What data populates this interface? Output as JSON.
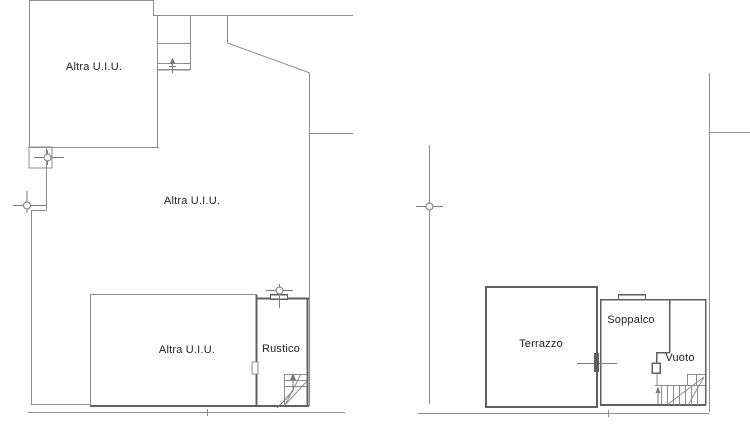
{
  "document_type": "cadastral floor plan drawing",
  "colors": {
    "background": "#ffffff",
    "line": "#8c8c8c",
    "wall": "#5f5f5f",
    "marker": "#7a7a7a",
    "text": "#222222",
    "white": "#ffffff"
  },
  "labels": {
    "room_upper_left": "Altra U.I.U.",
    "room_middle": "Altra U.I.U.",
    "room_lower": "Altra U.I.U.",
    "rustico": "Rustico",
    "terrazzo": "Terrazzo",
    "soppalco": "Soppalco",
    "vuoto": "Vuoto"
  },
  "floorplan": {
    "lines": [
      {
        "x1": 29,
        "y1": 0.5,
        "x2": 153,
        "y2": 0.5,
        "w": 1,
        "c": "line",
        "n": "top-wall"
      },
      {
        "x1": 29.5,
        "y1": 0,
        "x2": 29.5,
        "y2": 147,
        "w": 1,
        "c": "line",
        "n": "left-wall"
      },
      {
        "x1": 153.5,
        "y1": 0,
        "x2": 153.5,
        "y2": 15,
        "w": 1,
        "c": "line",
        "n": "wall-step"
      },
      {
        "x1": 153,
        "y1": 15.5,
        "x2": 353,
        "y2": 15.5,
        "w": 1,
        "c": "line",
        "n": "top-wall-right"
      },
      {
        "x1": 157.5,
        "y1": 15,
        "x2": 157.5,
        "y2": 147,
        "w": 1,
        "c": "line",
        "n": "shaft-left-wall"
      },
      {
        "x1": 190.5,
        "y1": 15,
        "x2": 190.5,
        "y2": 70,
        "w": 1,
        "c": "line",
        "n": "shaft-right-wall"
      },
      {
        "x1": 157,
        "y1": 43.5,
        "x2": 190,
        "y2": 43.5,
        "w": 1,
        "c": "line",
        "n": "shaft-landing-line"
      },
      {
        "x1": 157,
        "y1": 63.5,
        "x2": 190,
        "y2": 63.5,
        "w": 1,
        "c": "line",
        "n": "shaft-sill-outer"
      },
      {
        "x1": 157,
        "y1": 69.5,
        "x2": 190,
        "y2": 69.5,
        "w": 1.5,
        "c": "line",
        "n": "shaft-sill-inner"
      },
      {
        "x1": 172.5,
        "y1": 59,
        "x2": 172.5,
        "y2": 73,
        "w": 1,
        "c": "marker",
        "n": "shaft-arrow-shaft"
      },
      {
        "x1": 169,
        "y1": 66.5,
        "x2": 176,
        "y2": 66.5,
        "w": 1,
        "c": "marker",
        "n": "shaft-arrow-crossbar"
      },
      {
        "x1": 227.5,
        "y1": 15,
        "x2": 227.5,
        "y2": 43,
        "w": 1,
        "c": "line",
        "n": "upper-right-wall"
      },
      {
        "x1": 227.5,
        "y1": 43,
        "x2": 310,
        "y2": 73,
        "w": 1,
        "c": "line",
        "n": "diagonal-wall"
      },
      {
        "x1": 309.5,
        "y1": 73,
        "x2": 309.5,
        "y2": 406,
        "w": 1,
        "c": "line",
        "n": "right-wall"
      },
      {
        "x1": 310,
        "y1": 133.5,
        "x2": 353,
        "y2": 133.5,
        "w": 1,
        "c": "line",
        "n": "party-wall-line"
      },
      {
        "x1": 29,
        "y1": 147.5,
        "x2": 159,
        "y2": 147.5,
        "w": 1,
        "c": "line",
        "n": "room-divider-wall"
      },
      {
        "x1": 34,
        "y1": 157.5,
        "x2": 64,
        "y2": 157.5,
        "w": 1,
        "c": "marker",
        "n": "axis-marker-line"
      },
      {
        "x1": 47.5,
        "y1": 150,
        "x2": 47.5,
        "y2": 165,
        "w": 1,
        "c": "marker",
        "n": "axis-marker-line"
      },
      {
        "x1": 46.5,
        "y1": 147,
        "x2": 46.5,
        "y2": 210.5,
        "w": 1,
        "c": "line",
        "n": "mid-left-wall-upper"
      },
      {
        "x1": 31,
        "y1": 210.5,
        "x2": 46.5,
        "y2": 210.5,
        "w": 1,
        "c": "line",
        "n": "wall-jog"
      },
      {
        "x1": 31.5,
        "y1": 210.5,
        "x2": 31.5,
        "y2": 404,
        "w": 1,
        "c": "line",
        "n": "mid-left-wall-lower"
      },
      {
        "x1": 13,
        "y1": 205.5,
        "x2": 46,
        "y2": 205.5,
        "w": 1,
        "c": "marker",
        "n": "axis-marker-line"
      },
      {
        "x1": 27,
        "y1": 191,
        "x2": 27,
        "y2": 213,
        "w": 1,
        "c": "marker",
        "n": "axis-marker-line"
      },
      {
        "x1": 31,
        "y1": 404.5,
        "x2": 90,
        "y2": 404.5,
        "w": 1,
        "c": "line",
        "n": "annex-bottom-wall"
      },
      {
        "x1": 90.5,
        "y1": 294,
        "x2": 90.5,
        "y2": 407,
        "w": 1,
        "c": "line",
        "n": "lower-room-left-wall"
      },
      {
        "x1": 90,
        "y1": 294.5,
        "x2": 257,
        "y2": 294.5,
        "w": 1,
        "c": "line",
        "n": "lower-room-top-wall"
      },
      {
        "x1": 90,
        "y1": 406,
        "x2": 309,
        "y2": 406,
        "w": 2,
        "c": "wall",
        "n": "lower-room-bottom-wall"
      },
      {
        "x1": 256.5,
        "y1": 295,
        "x2": 256.5,
        "y2": 406,
        "w": 2,
        "c": "wall",
        "n": "rustico-left-wall"
      },
      {
        "x1": 257,
        "y1": 298.5,
        "x2": 270,
        "y2": 298.5,
        "w": 2,
        "c": "wall",
        "n": "rustico-top-wall"
      },
      {
        "x1": 288,
        "y1": 298.5,
        "x2": 309,
        "y2": 298.5,
        "w": 2,
        "c": "wall",
        "n": "rustico-top-wall"
      },
      {
        "x1": 270,
        "y1": 294.5,
        "x2": 288,
        "y2": 294.5,
        "w": 1.5,
        "c": "wall",
        "n": "window-outer-line"
      },
      {
        "x1": 270,
        "y1": 299,
        "x2": 288,
        "y2": 299,
        "w": 1.5,
        "c": "wall",
        "n": "window-inner-line"
      },
      {
        "x1": 270.5,
        "y1": 294,
        "x2": 270.5,
        "y2": 299,
        "w": 1,
        "c": "wall",
        "n": "window-cap"
      },
      {
        "x1": 287.5,
        "y1": 294,
        "x2": 287.5,
        "y2": 299,
        "w": 1,
        "c": "wall",
        "n": "window-cap"
      },
      {
        "x1": 279.5,
        "y1": 284,
        "x2": 279.5,
        "y2": 308,
        "w": 1,
        "c": "marker",
        "n": "window-axis-line"
      },
      {
        "x1": 266,
        "y1": 290.5,
        "x2": 293,
        "y2": 290.5,
        "w": 1,
        "c": "marker",
        "n": "window-axis-line"
      },
      {
        "x1": 307.5,
        "y1": 298,
        "x2": 307.5,
        "y2": 406,
        "w": 2,
        "c": "wall",
        "n": "rustico-right-wall"
      },
      {
        "x1": 284,
        "y1": 374.5,
        "x2": 307,
        "y2": 374.5,
        "w": 1,
        "c": "line",
        "n": "stair-tread"
      },
      {
        "x1": 284,
        "y1": 380.5,
        "x2": 307,
        "y2": 380.5,
        "w": 1,
        "c": "line",
        "n": "stair-tread"
      },
      {
        "x1": 284,
        "y1": 386.5,
        "x2": 307,
        "y2": 386.5,
        "w": 1,
        "c": "line",
        "n": "stair-tread"
      },
      {
        "x1": 284.5,
        "y1": 374,
        "x2": 284.5,
        "y2": 406,
        "w": 1,
        "c": "line",
        "n": "stair-edge"
      },
      {
        "x1": 285,
        "y1": 405,
        "x2": 307,
        "y2": 381,
        "w": 1,
        "c": "line",
        "n": "stair-winder-line"
      },
      {
        "x1": 285,
        "y1": 405,
        "x2": 301,
        "y2": 374,
        "w": 1,
        "c": "line",
        "n": "stair-winder-line"
      },
      {
        "x1": 28,
        "y1": 412.5,
        "x2": 345,
        "y2": 412.5,
        "w": 1,
        "c": "line",
        "n": "baseline"
      },
      {
        "x1": 207.5,
        "y1": 409,
        "x2": 207.5,
        "y2": 416,
        "w": 1,
        "c": "line",
        "n": "baseline-tick"
      },
      {
        "x1": 429.5,
        "y1": 145,
        "x2": 429.5,
        "y2": 404,
        "w": 1,
        "c": "line",
        "n": "left-wall"
      },
      {
        "x1": 416,
        "y1": 206.5,
        "x2": 443,
        "y2": 206.5,
        "w": 1,
        "c": "marker",
        "n": "axis-marker-line"
      },
      {
        "x1": 418,
        "y1": 413.5,
        "x2": 709,
        "y2": 413.5,
        "w": 1,
        "c": "line",
        "n": "baseline"
      },
      {
        "x1": 608.5,
        "y1": 410,
        "x2": 608.5,
        "y2": 417,
        "w": 1,
        "c": "line",
        "n": "baseline-tick"
      },
      {
        "x1": 709.5,
        "y1": 73,
        "x2": 709.5,
        "y2": 412,
        "w": 1,
        "c": "line",
        "n": "right-wall"
      },
      {
        "x1": 709,
        "y1": 132.5,
        "x2": 750,
        "y2": 132.5,
        "w": 1,
        "c": "line",
        "n": "party-wall-line"
      },
      {
        "x1": 600,
        "y1": 299.5,
        "x2": 706,
        "y2": 299.5,
        "w": 1.5,
        "c": "wall",
        "n": "soppalco-top-wall"
      },
      {
        "x1": 618,
        "y1": 294.5,
        "x2": 646,
        "y2": 294.5,
        "w": 1.5,
        "c": "wall",
        "n": "window-outer-line"
      },
      {
        "x1": 618.5,
        "y1": 294,
        "x2": 618.5,
        "y2": 300,
        "w": 1,
        "c": "wall",
        "n": "window-cap"
      },
      {
        "x1": 645.5,
        "y1": 294,
        "x2": 645.5,
        "y2": 300,
        "w": 1,
        "c": "wall",
        "n": "window-cap"
      },
      {
        "x1": 600.5,
        "y1": 299,
        "x2": 600.5,
        "y2": 405,
        "w": 1.5,
        "c": "wall",
        "n": "soppalco-left-wall"
      },
      {
        "x1": 705.5,
        "y1": 299,
        "x2": 705.5,
        "y2": 405,
        "w": 1.5,
        "c": "wall",
        "n": "soppalco-right-wall"
      },
      {
        "x1": 600,
        "y1": 405,
        "x2": 706,
        "y2": 405,
        "w": 2,
        "c": "wall",
        "n": "soppalco-bottom-wall"
      },
      {
        "x1": 669.5,
        "y1": 299,
        "x2": 669.5,
        "y2": 352,
        "w": 1.5,
        "c": "wall",
        "n": "soppalco-inner-wall"
      },
      {
        "x1": 656,
        "y1": 352.5,
        "x2": 670,
        "y2": 352.5,
        "w": 1.5,
        "c": "wall",
        "n": "soppalco-inner-wall"
      },
      {
        "x1": 656.5,
        "y1": 352,
        "x2": 656.5,
        "y2": 363,
        "w": 1.5,
        "c": "wall",
        "n": "soppalco-inner-wall"
      },
      {
        "x1": 657,
        "y1": 373,
        "x2": 657,
        "y2": 385,
        "w": 1,
        "c": "line",
        "n": "vuoto-wall"
      },
      {
        "x1": 687,
        "y1": 374.5,
        "x2": 705,
        "y2": 374.5,
        "w": 1,
        "c": "line",
        "n": "stair-landing"
      },
      {
        "x1": 687.5,
        "y1": 374,
        "x2": 687.5,
        "y2": 385,
        "w": 1,
        "c": "line",
        "n": "stair-landing"
      },
      {
        "x1": 696.5,
        "y1": 374,
        "x2": 696.5,
        "y2": 385,
        "w": 1,
        "c": "line",
        "n": "stair-landing"
      },
      {
        "x1": 655,
        "y1": 385.5,
        "x2": 705,
        "y2": 385.5,
        "w": 1,
        "c": "line",
        "n": "stair-top-line"
      },
      {
        "x1": 661.5,
        "y1": 385,
        "x2": 661.5,
        "y2": 405,
        "w": 1,
        "c": "line",
        "n": "stair-tread"
      },
      {
        "x1": 667.5,
        "y1": 385,
        "x2": 667.5,
        "y2": 405,
        "w": 1,
        "c": "line",
        "n": "stair-tread"
      },
      {
        "x1": 673.5,
        "y1": 385,
        "x2": 673.5,
        "y2": 405,
        "w": 1,
        "c": "line",
        "n": "stair-tread"
      },
      {
        "x1": 679.5,
        "y1": 385,
        "x2": 679.5,
        "y2": 405,
        "w": 1,
        "c": "line",
        "n": "stair-tread"
      },
      {
        "x1": 685.5,
        "y1": 385,
        "x2": 685.5,
        "y2": 405,
        "w": 1,
        "c": "line",
        "n": "stair-tread"
      },
      {
        "x1": 691.5,
        "y1": 385,
        "x2": 691.5,
        "y2": 405,
        "w": 1,
        "c": "line",
        "n": "stair-tread"
      },
      {
        "x1": 697.5,
        "y1": 385,
        "x2": 697.5,
        "y2": 405,
        "w": 1,
        "c": "line",
        "n": "stair-tread"
      },
      {
        "x1": 704,
        "y1": 377,
        "x2": 667,
        "y2": 405,
        "w": 1,
        "c": "line",
        "n": "stair-winder-line"
      },
      {
        "x1": 704,
        "y1": 377,
        "x2": 688,
        "y2": 405,
        "w": 1,
        "c": "line",
        "n": "stair-winder-line"
      },
      {
        "x1": 658,
        "y1": 404,
        "x2": 658,
        "y2": 390,
        "w": 1,
        "c": "marker",
        "n": "stair-arrow-shaft"
      },
      {
        "x1": 577,
        "y1": 363.5,
        "x2": 617,
        "y2": 363.5,
        "w": 1,
        "c": "marker",
        "n": "axis-marker-line"
      }
    ],
    "rects": [
      {
        "x": 29,
        "y": 147,
        "w": 23,
        "h": 21,
        "sw": 1,
        "c": "line",
        "fill": "none",
        "n": "annex-step-outline"
      },
      {
        "x": 486,
        "y": 287,
        "w": 111,
        "h": 120,
        "sw": 2,
        "c": "wall",
        "fill": "none",
        "n": "terrazzo-outline"
      },
      {
        "x": 252,
        "y": 362,
        "w": 6,
        "h": 12,
        "sw": 1,
        "c": "line",
        "fill": "white",
        "n": "door-jamb"
      },
      {
        "x": 652,
        "y": 363,
        "w": 8,
        "h": 10,
        "sw": 1.5,
        "c": "wall",
        "fill": "white",
        "n": "door-jamb"
      },
      {
        "x": 594,
        "y": 353,
        "w": 5,
        "h": 19,
        "sw": 0,
        "c": "wall",
        "fill": "wall",
        "n": "wall-marker-block"
      }
    ],
    "circles": [
      {
        "cx": 47.5,
        "cy": 157.5,
        "r": 3.5,
        "n": "axis-marker-circle"
      },
      {
        "cx": 27,
        "cy": 205.5,
        "r": 3.5,
        "n": "axis-marker-circle"
      },
      {
        "cx": 279.5,
        "cy": 290.5,
        "r": 3.5,
        "n": "axis-marker-circle"
      },
      {
        "cx": 429.5,
        "cy": 206.5,
        "r": 3.5,
        "n": "axis-marker-circle"
      }
    ],
    "paths": [
      {
        "d": "M169.5,64 L172.5,57.5 L175.5,64 Z",
        "fill": "marker",
        "sw": 0,
        "c": "marker",
        "n": "shaft-arrow-head"
      },
      {
        "d": "M277,408 L293,391 L293,377",
        "fill": "none",
        "sw": 1,
        "c": "marker",
        "n": "stair-arrow-shaft"
      },
      {
        "d": "M290,380 L293,373 L296,380 Z",
        "fill": "marker",
        "sw": 0,
        "c": "marker",
        "n": "stair-arrow-head"
      },
      {
        "d": "M655.5,393 L658,386.5 L660.5,393 Z",
        "fill": "marker",
        "sw": 0,
        "c": "marker",
        "n": "stair-arrow-head"
      }
    ]
  }
}
